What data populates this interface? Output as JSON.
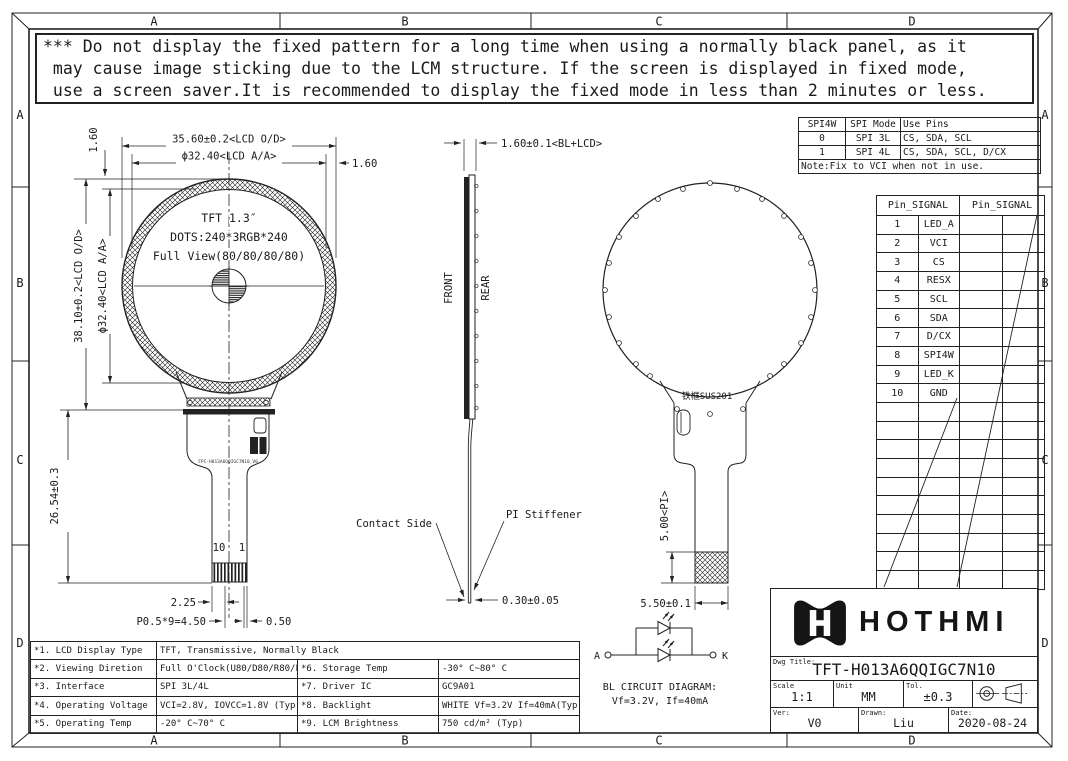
{
  "frame": {
    "zone_cols": [
      "A",
      "B",
      "C",
      "D"
    ],
    "zone_rows": [
      "A",
      "B",
      "C",
      "D"
    ]
  },
  "warning": {
    "lines": [
      "*** Do not display the fixed pattern for a long time when using a normally black panel, as it",
      " may cause image sticking due to the LCM structure. If the screen is displayed in fixed mode,",
      " use a screen saver.It is recommended to display the fixed mode in less than 2 minutes or less."
    ]
  },
  "front_view": {
    "dim_width_od": "35.60±0.2<LCD O/D>",
    "dim_width_aa": "ϕ32.40<LCD A/A>",
    "dim_border_top": "1.60",
    "dim_border_right": "1.60",
    "dim_height_od": "38.10±0.2<LCD O/D>",
    "dim_height_aa": "ϕ32.40<LCD A/A>",
    "dim_fpc_length": "26.54±0.3",
    "panel_size": "TFT 1.3″",
    "panel_dots": "DOTS:240*3RGB*240",
    "panel_view": "Full View(80/80/80/80)",
    "fpc_label": "FPC-H013A6QQIGC7N10_V0",
    "pin_10": "10",
    "pin_1": "1",
    "dim_pin_offset": "2.25",
    "dim_pin_pitch": "P0.5*9=4.50",
    "dim_pin_width": "0.50"
  },
  "side_view": {
    "dim_thickness": "1.60±0.1<BL+LCD>",
    "label_front": "FRONT",
    "label_rear": "REAR",
    "label_contact": "Contact Side",
    "label_stiffener": "PI Stiffener",
    "dim_fpc_thickness": "0.30±0.05"
  },
  "rear_view": {
    "frame_material": "铁框SUS201",
    "dim_pi": "5.00<PI>",
    "dim_fpc_width": "5.50±0.1"
  },
  "spi_table": {
    "headers": [
      "SPI4W",
      "SPI Mode",
      "Use Pins"
    ],
    "rows": [
      [
        "0",
        "SPI 3L",
        "CS, SDA, SCL"
      ],
      [
        "1",
        "SPI 4L",
        "CS, SDA, SCL, D/CX"
      ]
    ],
    "note": "Note:Fix to VCI when not in use."
  },
  "pin_table": {
    "headers": [
      "Pin_SIGNAL",
      "Pin_SIGNAL"
    ],
    "pins": [
      [
        "1",
        "LED_A"
      ],
      [
        "2",
        "VCI"
      ],
      [
        "3",
        "CS"
      ],
      [
        "4",
        "RESX"
      ],
      [
        "5",
        "SCL"
      ],
      [
        "6",
        "SDA"
      ],
      [
        "7",
        "D/CX"
      ],
      [
        "8",
        "SPI4W"
      ],
      [
        "9",
        "LED_K"
      ],
      [
        "10",
        "GND"
      ]
    ]
  },
  "spec_table": {
    "rows": [
      {
        "l": "*1. LCD Display Type",
        "v": "TFT, Transmissive, Normally Black",
        "l2": "",
        "v2": ""
      },
      {
        "l": "*2. Viewing Diretion",
        "v": "Full O'Clock(U80/D80/R80/L80)",
        "l2": "*6. Storage Temp",
        "v2": "-30° C~80° C"
      },
      {
        "l": "*3. Interface",
        "v": "SPI 3L/4L",
        "l2": "*7. Driver IC",
        "v2": "GC9A01"
      },
      {
        "l": "*4. Operating Voltage",
        "v": "VCI=2.8V, IOVCC=1.8V (Typ)",
        "l2": "*8. Backlight",
        "v2": "WHITE Vf=3.2V If=40mA(Typ)"
      },
      {
        "l": "*5. Operating Temp",
        "v": "-20° C~70° C",
        "l2": "*9. LCM Brightness",
        "v2": "750 cd/m² (Typ)"
      }
    ]
  },
  "bl_circuit": {
    "anode": "A",
    "cathode": "K",
    "caption_title": "BL CIRCUIT DIAGRAM:",
    "caption_spec": "Vf=3.2V, If=40mA"
  },
  "title_block": {
    "brand": "HOTHMI",
    "dwg_title_label": "Dwg Title:",
    "dwg_title": "TFT-H013A6QQIGC7N10",
    "scale_label": "Scale",
    "scale_value": "1:1",
    "unit_label": "Unit",
    "unit_value": "MM",
    "tol_label": "Tol.",
    "tol_value": "±0.3",
    "ver_label": "Ver:",
    "ver_value": "V0",
    "drawn_label": "Drawn:",
    "drawn_value": "Liu",
    "date_label": "Date:",
    "date_value": "2020-08-24"
  }
}
